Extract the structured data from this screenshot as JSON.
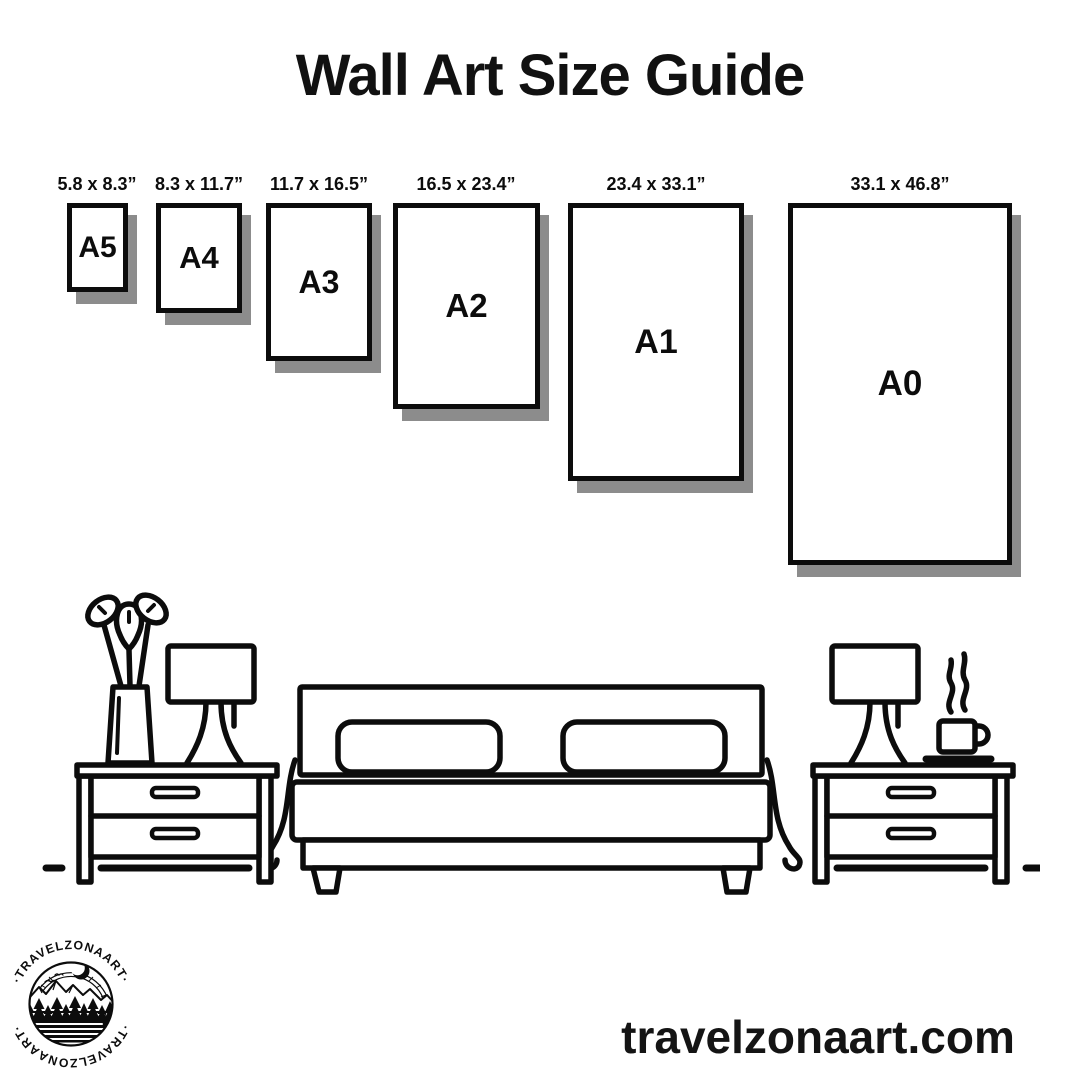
{
  "title": "Wall Art Size Guide",
  "sizes": [
    {
      "name": "A5",
      "dimensions": "5.8 x 8.3”"
    },
    {
      "name": "A4",
      "dimensions": "8.3 x 11.7”"
    },
    {
      "name": "A3",
      "dimensions": "11.7 x 16.5”"
    },
    {
      "name": "A2",
      "dimensions": "16.5 x 23.4”"
    },
    {
      "name": "A1",
      "dimensions": "23.4 x 33.1”"
    },
    {
      "name": "A0",
      "dimensions": "33.1 x 46.8”"
    }
  ],
  "logo": {
    "brand": "TRAVELZONAART",
    "arc_top": "·TRAVELZONAART·",
    "arc_bottom": "·TRAVELZONAART·"
  },
  "footer": {
    "website": "travelzonaart.com"
  },
  "colors": {
    "ink": "#0c0c0c",
    "shadow": "#8c8c8c",
    "background": "#ffffff"
  },
  "icons": [
    "bed-icon",
    "pillow-icon",
    "nightstand-icon",
    "lamp-icon",
    "plant-vase-icon",
    "coffee-cup-icon",
    "steam-icon",
    "mountain-logo-icon",
    "moon-icon",
    "pine-tree-icon"
  ]
}
